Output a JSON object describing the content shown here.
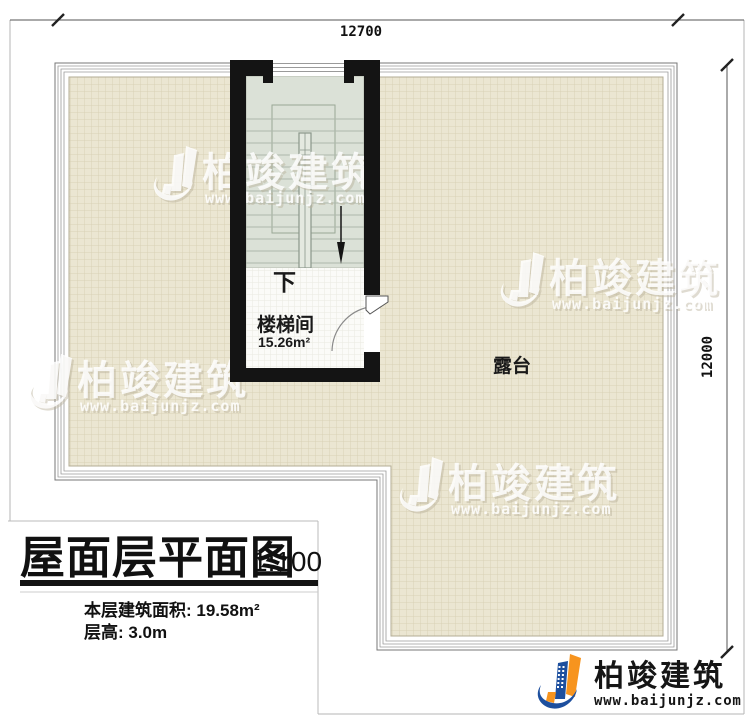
{
  "dimensions": {
    "top": "12700",
    "right": "12000"
  },
  "plan": {
    "stair_room": {
      "label": "楼梯间",
      "area": "15.26m²",
      "direction": "下"
    },
    "terrace": {
      "label": "露台"
    }
  },
  "title_block": {
    "title": "屋面层平面图",
    "scale": "1:100",
    "area_line": "本层建筑面积: 19.58m²",
    "height_line": "层高: 3.0m"
  },
  "watermark": {
    "brand": "柏竣建筑",
    "url": "www.baijunjz.com"
  },
  "logo": {
    "brand": "柏竣建筑",
    "url": "www.baijunjz.com"
  },
  "colors": {
    "wall": "#141414",
    "tile_bg": "#ebe6d2",
    "tile_line": "#d8d1b6",
    "stair_floor": "#dbe1d7",
    "brand_orange": "#f7941e",
    "brand_blue": "#1d4f9e",
    "watermark_shadow": "#b9b19a"
  }
}
